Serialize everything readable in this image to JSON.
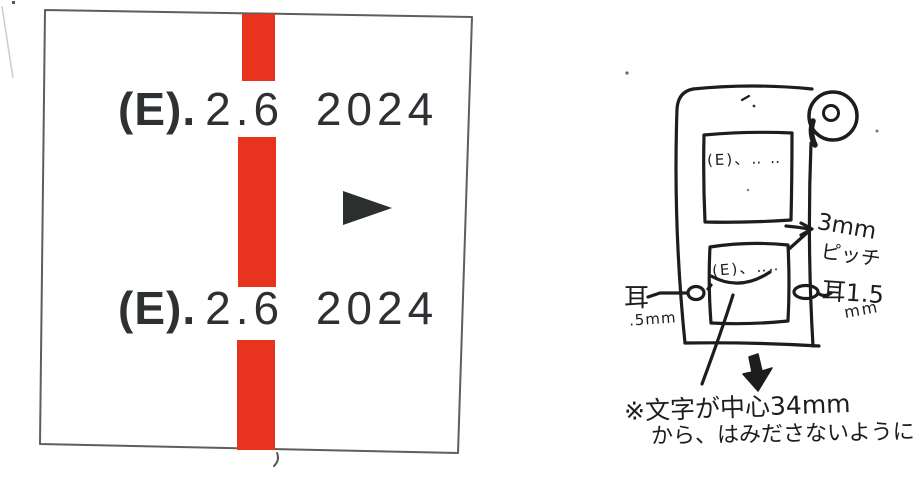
{
  "colors": {
    "stripe_red": "#e8341f",
    "arrow_dark": "#2b2f2f",
    "ink": "#1d1d1d",
    "outline_gray": "#5e5e5e"
  },
  "label_sample": {
    "line1_prefix": "(E).",
    "line1_value": "2.6 2024",
    "line2_prefix": "(E).",
    "line2_value": "2.6 2024"
  },
  "sketch": {
    "upper_frame_label": "(E)、‥ ‥",
    "lower_frame_label": "(E)、‥‥",
    "pitch_value": "3mm",
    "pitch_unit": "ピッチ",
    "left_ear_label": "耳",
    "left_ear_value": ".5mm",
    "right_ear_label": "耳1.5",
    "right_ear_unit": "mm",
    "note_line1": "※文字が中心34mm",
    "note_line2": "から、はみださないように"
  }
}
